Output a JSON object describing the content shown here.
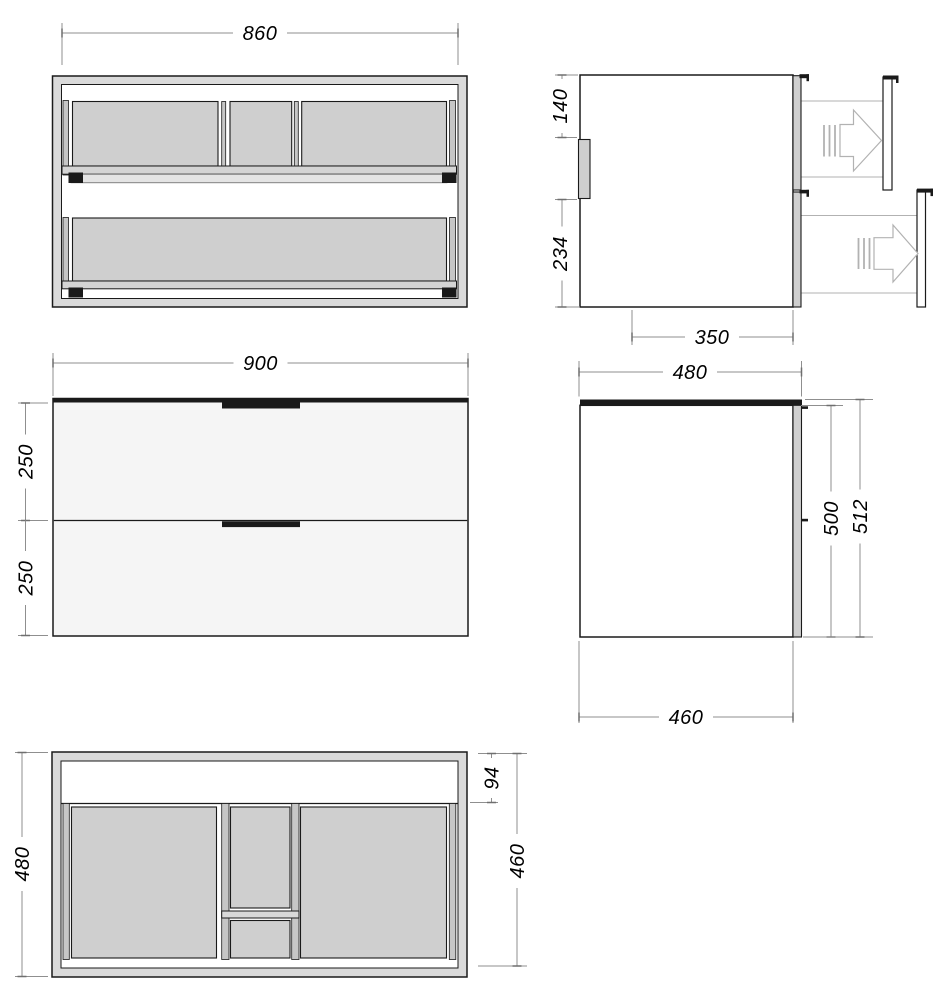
{
  "colors": {
    "background": "#ffffff",
    "ink": "#1a1a1a",
    "panel_gray": "#cfcfcf",
    "wall_gray": "#dadada",
    "rail_gray": "#c6c6c6",
    "band_gray": "#e4e4e4",
    "face_light": "#f5f5f5",
    "dim_gray": "#8f8f8f",
    "construction_gray": "#b2b2b2"
  },
  "dimensions": {
    "front_open_width": "860",
    "side_extended_upper": "140",
    "side_extended_lower": "234",
    "side_extended_depth": "350",
    "front_overall_width": "900",
    "front_upper_drawer": "250",
    "front_lower_drawer": "250",
    "side_overall_depth": "480",
    "side_front_height": "500",
    "side_overall_height": "512",
    "side_body_depth": "460",
    "plan_overall_depth": "480",
    "plan_front_rail": "94",
    "plan_drawer_depth": "460"
  }
}
